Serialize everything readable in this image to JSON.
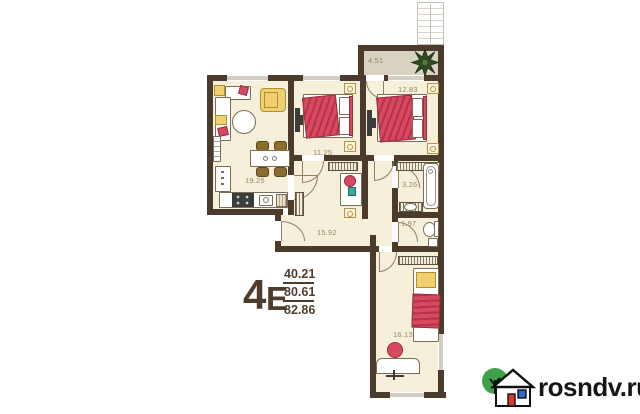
{
  "title": "4-room apartment floor plan",
  "rooms": {
    "balcony": "4.51",
    "bedroom_top": "12.83",
    "bedroom_mid": "11.25",
    "kitchen_living": "19.25",
    "bathroom": "3.26",
    "wc": "1.97",
    "hallway": "15.92",
    "bedroom_bottom": "16.13"
  },
  "summary": {
    "type_digit": "4",
    "type_letter": "Е",
    "living_area": "40.21",
    "floor_area": "80.61",
    "total_area": "82.86"
  },
  "branding": {
    "site": "rosndv.ru"
  },
  "icons": {
    "logo": "house-with-tree-icon",
    "balcony_plant": "plant-icon",
    "stairs": "fire-escape-ladder-icon"
  },
  "colors": {
    "wall": "#4a3b2c",
    "floor": "#f6f0da",
    "balcony_floor": "#d8d3c1",
    "accent_red": "#d6495e",
    "accent_yellow": "#f0d070",
    "label_text": "#96866a",
    "summary_text": "#4e3d2c",
    "logo_green": "#3fa24a",
    "logo_door_red": "#d93a2b",
    "logo_window_blue": "#2f66c9"
  }
}
